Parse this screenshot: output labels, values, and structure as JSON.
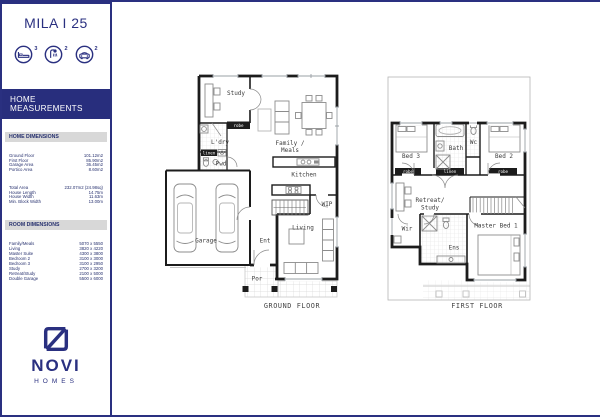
{
  "sidebar": {
    "title": "MILA I 25",
    "features": [
      {
        "name": "bedrooms",
        "count": "3"
      },
      {
        "name": "bathrooms",
        "count": "2"
      },
      {
        "name": "garage",
        "count": "2"
      }
    ],
    "band": "HOME MEASUREMENTS",
    "home_dimensions": {
      "header": "HOME DIMENSIONS",
      "rows": [
        {
          "label": "Ground Floor",
          "value": "101.12m2"
        },
        {
          "label": "First Floor",
          "value": "85.90m2"
        },
        {
          "label": "Garage Area",
          "value": "36.45m2"
        },
        {
          "label": "Portico Area",
          "value": "8.60m2"
        }
      ],
      "totals": [
        {
          "label": "Total Area",
          "value": "232.07m2 (24.98sq)"
        },
        {
          "label": "House Length",
          "value": "14.75m"
        },
        {
          "label": "House Width",
          "value": "11.63m"
        },
        {
          "label": "Min. Block Width",
          "value": "13.00m"
        }
      ]
    },
    "room_dimensions": {
      "header": "ROOM DIMENSIONS",
      "rows": [
        {
          "label": "Family/Meals",
          "value": "5070 x 5550"
        },
        {
          "label": "Living",
          "value": "3820 x 4220"
        },
        {
          "label": "Master Suite",
          "value": "4300 x 3800"
        },
        {
          "label": "Bedroom 2",
          "value": "3100 x 3000"
        },
        {
          "label": "Bedroom 3",
          "value": "3100 x 2950"
        },
        {
          "label": "Study",
          "value": "2700 x 3200"
        },
        {
          "label": "Retreat/Study",
          "value": "2100 x 5000"
        },
        {
          "label": "Double Garage",
          "value": "5500 x 6000"
        }
      ]
    },
    "logo": {
      "name": "NOVI",
      "sub": "HOMES"
    }
  },
  "plans": {
    "ground": {
      "caption": "GROUND FLOOR",
      "labels": {
        "study": "Study",
        "robe": "robe",
        "ldry": "L'dry",
        "linen": "linen",
        "pwd": "Pwd",
        "family1": "Family /",
        "family2": "Meals",
        "kitchen": "Kitchen",
        "wip": "WIP",
        "garage": "Garage",
        "ent": "Ent",
        "living": "Living",
        "por": "Por"
      }
    },
    "first": {
      "caption": "FIRST FLOOR",
      "labels": {
        "bed3": "Bed 3",
        "bath": "Bath",
        "wc": "Wc",
        "bed2": "Bed 2",
        "robe_l": "robe",
        "linen": "linen",
        "robe_r": "robe",
        "retreat1": "Retreat/",
        "retreat2": "Study",
        "wir": "Wir",
        "ens": "Ens",
        "master": "Master Bed 1"
      }
    }
  },
  "colors": {
    "navy": "#2a3080",
    "band": "#282e7d",
    "bar_gray": "#d8d8d8"
  }
}
